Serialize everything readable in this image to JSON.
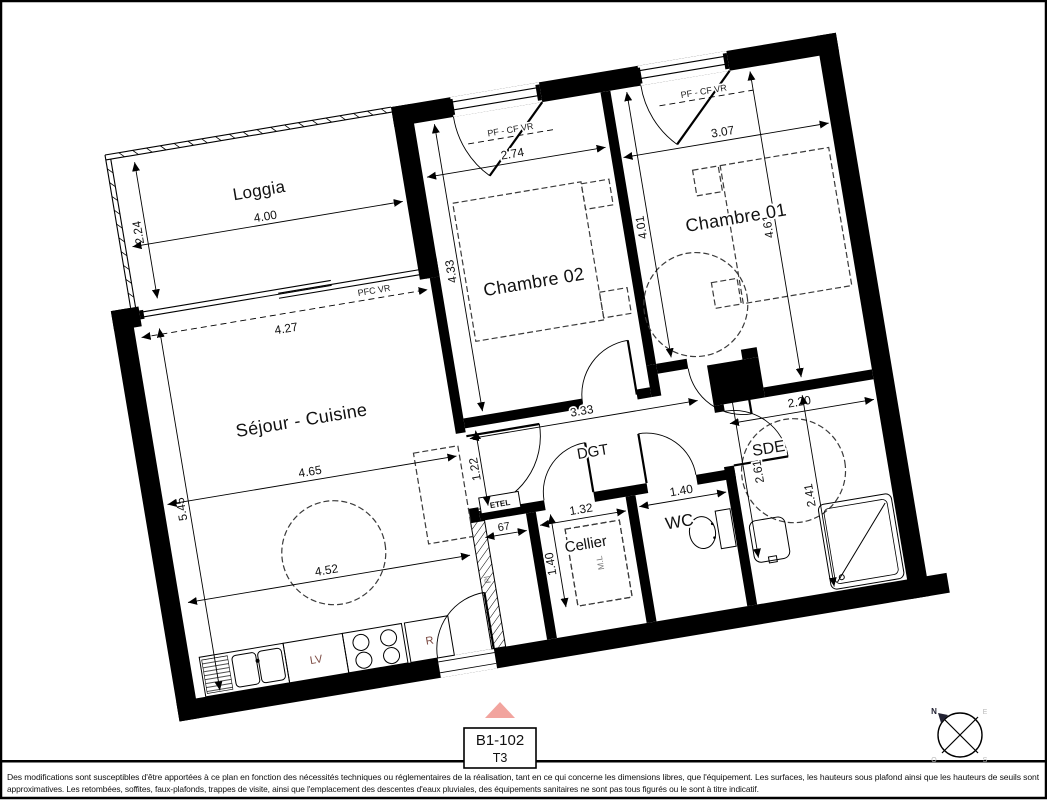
{
  "plan": {
    "unit_label": "B1-102",
    "unit_type": "T3",
    "rooms": {
      "loggia": "Loggia",
      "chambre02": "Chambre 02",
      "chambre01": "Chambre 01",
      "sejour": "Séjour - Cuisine",
      "dgt": "DGT",
      "sde": "SDE",
      "cellier": "Cellier",
      "wc": "WC"
    },
    "dims": {
      "loggia_depth": "2.24",
      "loggia_width": "4.00",
      "bay_width": "4.27",
      "ch02_width": "2.74",
      "ch02_length": "4.33",
      "ch01_width": "3.07",
      "ch01_length_left": "4.01",
      "ch01_length_right": "4.61",
      "sejour_length": "5.45",
      "sejour_width": "4.65",
      "sejour_width_lower": "4.52",
      "dgt_length": "3.33",
      "dgt_width": "1.22",
      "sde_corridor": "2.61",
      "sde_width": "2.20",
      "sde_length": "2.41",
      "cellier_width": "1.32",
      "cellier_depth": "1.40",
      "wc_width": "1.40",
      "entry_niche": "67"
    },
    "window_codes": {
      "bay": "PFC VR",
      "ch02_window": "PF - CF VR",
      "ch01_window": "PF - CF VR"
    },
    "fixtures": {
      "dishwasher": "LV",
      "fridge": "R",
      "washing_machine": "M.L",
      "closet": "Pl",
      "utility_panel": "ETEL"
    },
    "compass": {
      "n": "N",
      "e": "E",
      "s": "S",
      "o": "O"
    }
  },
  "colors": {
    "wall": "#000000",
    "entrance_marker": "#f2a49e",
    "fixture_label": "#7c4a42"
  },
  "footer": {
    "line1": "Des modifications sont susceptibles d'être apportées à ce plan en fonction des nécessités techniques ou réglementaires de la réalisation, tant en ce qui concerne les dimensions libres, que l'équipement. Les surfaces, les hauteurs sous plafond ainsi que les hauteurs de seuils sont",
    "line2": "approximatives. Les retombées, soffites, faux-plafonds, trappes de visite, ainsi que l'emplacement des descentes d'eaux pluviales, des équipements sanitaires ne sont pas tous figurés ou le sont à titre indicatif."
  }
}
